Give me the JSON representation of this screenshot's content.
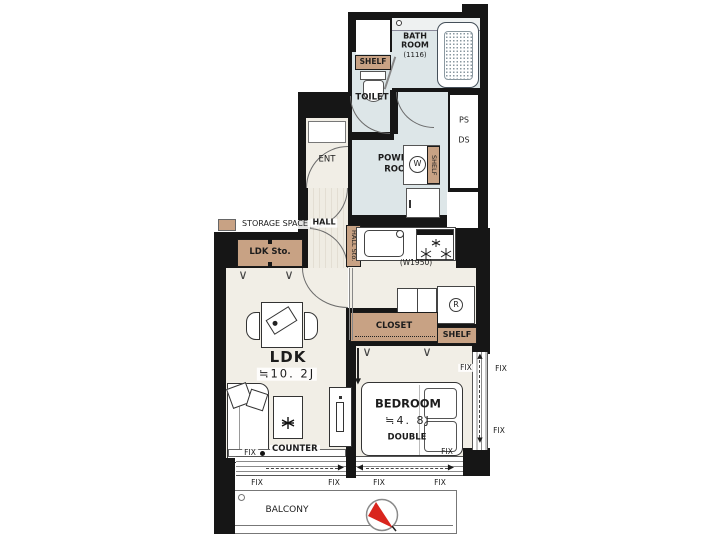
{
  "legend": {
    "storage_space": "STORAGE SPACE"
  },
  "labels": {
    "shelf": "SHELF",
    "bath_room_1": "BATH",
    "bath_room_2": "ROOM",
    "bath_size": "(1116)",
    "toilet": "TOILET",
    "ps": "PS",
    "ds": "DS",
    "ent": "ENT",
    "powder_1": "POWDER",
    "powder_2": "ROOM",
    "washer": "W",
    "hall": "HALL",
    "hall_sto": "HALL Sto.",
    "ldk_sto": "LDK Sto.",
    "kitchen_width": "(W1950)",
    "fridge": "R",
    "closet": "CLOSET",
    "ldk": "LDK",
    "ldk_size": "≒10. 2J",
    "bedroom": "BEDROOM",
    "bedroom_size": "≒4. 8J",
    "bed_type": "DOUBLE",
    "counter": "COUNTER",
    "fix": "FIX",
    "balcony": "BALCONY",
    "curtain_mark": "∨"
  },
  "colors": {
    "wall": "#161616",
    "floor": "#f1eee6",
    "wet_floor": "#dde6e8",
    "storage": "#c8a284",
    "compass_red": "#d9251d"
  }
}
